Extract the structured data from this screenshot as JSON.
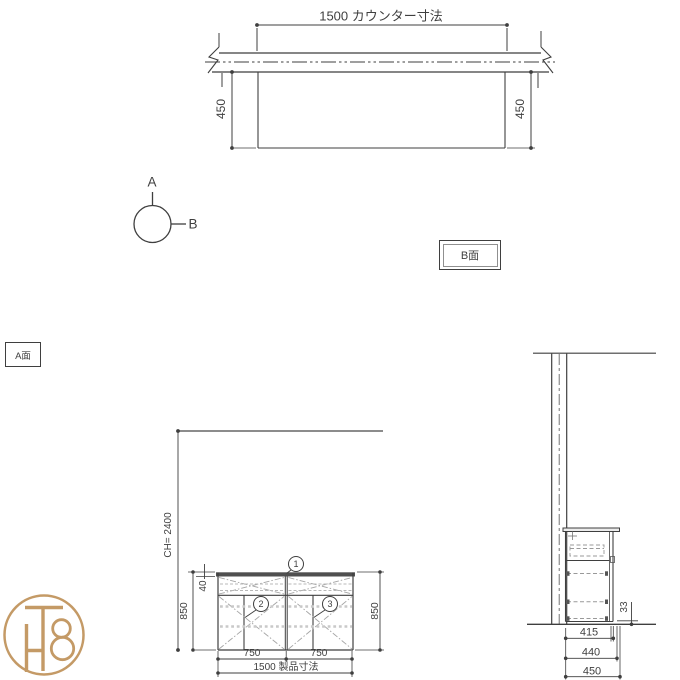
{
  "palette": {
    "background": "#ffffff",
    "line_dark": "#3f3f3f",
    "line_gray": "#8c8c8c",
    "logo_tan": "#c49a66"
  },
  "plan_view": {
    "counter_dim": "1500 カウンター寸法",
    "depth_left": "450",
    "depth_right": "450"
  },
  "section_marker": {
    "label_a": "A",
    "label_b": "B"
  },
  "face_labels": {
    "b_face": "B面",
    "a_face": "A面"
  },
  "elevation": {
    "ceiling_height": "CH= 2400",
    "height_left": "850",
    "counter_thickness": "40",
    "height_right": "850",
    "balloon_1": "1",
    "balloon_2": "2",
    "balloon_3": "3",
    "door_width_left": "750",
    "door_width_right": "750",
    "product_dim": "1500 製品寸法"
  },
  "side_view": {
    "bottom_gap": "33",
    "depth_carcass": "415",
    "depth_with_door": "440",
    "depth_counter": "450"
  },
  "logo": {
    "monogram": "TH8"
  }
}
